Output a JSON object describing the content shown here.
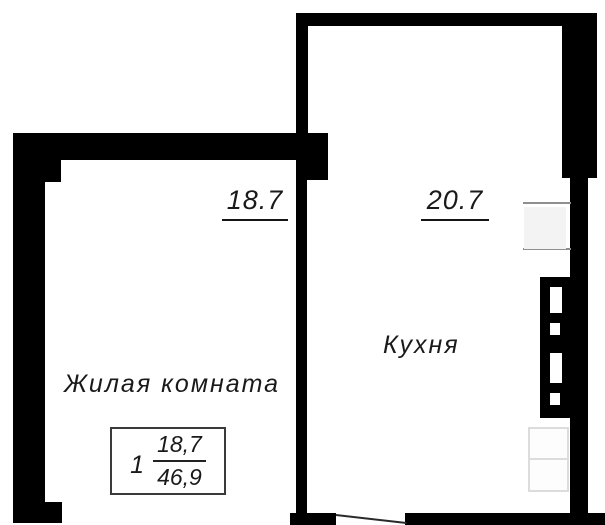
{
  "plan": {
    "living_room": {
      "name": "Жилая комната",
      "area": "18.7"
    },
    "kitchen": {
      "name": "Кухня",
      "area": "20.7"
    },
    "stamp": {
      "room_number": "1",
      "living_area": "18,7",
      "total_area": "46,9"
    }
  },
  "colors": {
    "wall": "#000000",
    "text": "#1a1a1a",
    "sill_line": "#8f8f8f",
    "faint_outline": "#dcdcdc"
  }
}
